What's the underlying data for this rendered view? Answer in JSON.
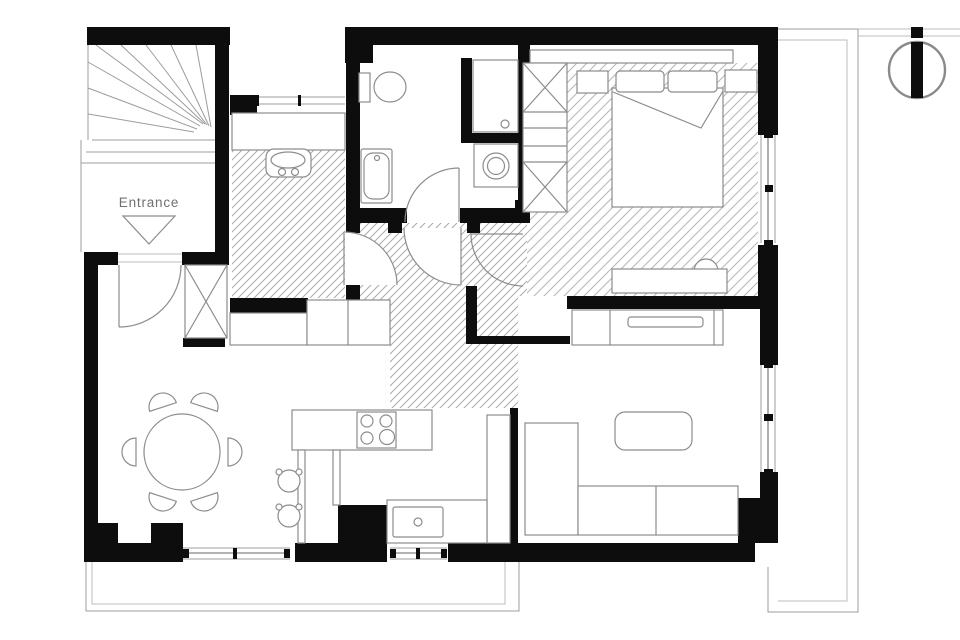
{
  "plan": {
    "type": "apartment-floor-plan",
    "entrance_label": "Entrance",
    "icons": {
      "north_indicator": "north-indicator-circle-with-needle"
    },
    "colors": {
      "walls": "#0d0d0d",
      "furniture_outline": "#8c8c8c",
      "hatch": "#ababab",
      "label_text": "#707070",
      "background": "#ffffff"
    }
  }
}
